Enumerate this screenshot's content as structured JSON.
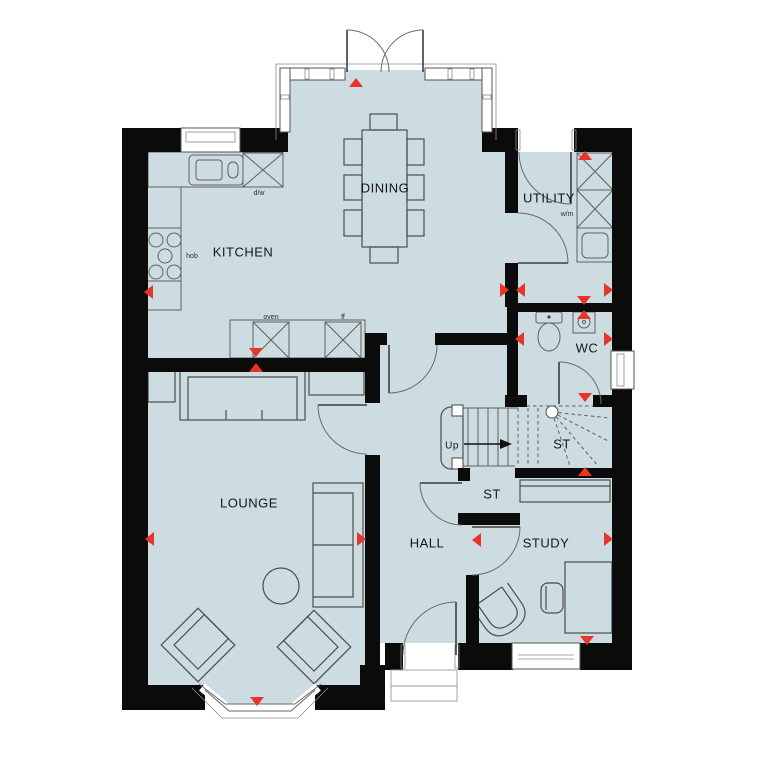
{
  "plan": {
    "type": "ground-floor-plan",
    "colors": {
      "floor": "#ccdce1",
      "wall": "#0b0b0b",
      "marker": "#e8352b",
      "outline": "#4d4d4d"
    },
    "rooms": [
      {
        "id": "dining",
        "label": "DINING",
        "x": 385,
        "y": 189,
        "size": 13
      },
      {
        "id": "kitchen",
        "label": "KITCHEN",
        "x": 243,
        "y": 253,
        "size": 13
      },
      {
        "id": "utility",
        "label": "UTILITY",
        "x": 549,
        "y": 199,
        "size": 13
      },
      {
        "id": "wc",
        "label": "WC",
        "x": 587,
        "y": 349,
        "size": 13
      },
      {
        "id": "st-stairs",
        "label": "ST",
        "x": 562,
        "y": 445,
        "size": 13
      },
      {
        "id": "st-store",
        "label": "ST",
        "x": 492,
        "y": 495,
        "size": 13
      },
      {
        "id": "lounge",
        "label": "LOUNGE",
        "x": 249,
        "y": 504,
        "size": 13
      },
      {
        "id": "hall",
        "label": "HALL",
        "x": 427,
        "y": 544,
        "size": 13
      },
      {
        "id": "study",
        "label": "STUDY",
        "x": 546,
        "y": 544,
        "size": 13
      }
    ],
    "fixture_labels": [
      {
        "id": "dw",
        "label": "d/w",
        "x": 259,
        "y": 193,
        "size": 7
      },
      {
        "id": "hob",
        "label": "hob",
        "x": 192,
        "y": 256,
        "size": 7
      },
      {
        "id": "oven",
        "label": "oven",
        "x": 271,
        "y": 317,
        "size": 7
      },
      {
        "id": "ff",
        "label": "ff",
        "x": 343,
        "y": 317,
        "size": 7
      },
      {
        "id": "wm",
        "label": "w/m",
        "x": 567,
        "y": 214,
        "size": 7
      }
    ],
    "stairs": {
      "direction_label": "Up",
      "x": 452,
      "y": 446,
      "size": 10
    },
    "markers": [
      {
        "dir": "up",
        "x": 356,
        "y": 83
      },
      {
        "dir": "up",
        "x": 585,
        "y": 156
      },
      {
        "dir": "left",
        "x": 149,
        "y": 292
      },
      {
        "dir": "right",
        "x": 504,
        "y": 290
      },
      {
        "dir": "left",
        "x": 521,
        "y": 290
      },
      {
        "dir": "right",
        "x": 608,
        "y": 290
      },
      {
        "dir": "down",
        "x": 584,
        "y": 300
      },
      {
        "dir": "up",
        "x": 584,
        "y": 315
      },
      {
        "dir": "down",
        "x": 256,
        "y": 352
      },
      {
        "dir": "up",
        "x": 256,
        "y": 368
      },
      {
        "dir": "left",
        "x": 520,
        "y": 339
      },
      {
        "dir": "right",
        "x": 608,
        "y": 339
      },
      {
        "dir": "down",
        "x": 585,
        "y": 397
      },
      {
        "dir": "up",
        "x": 585,
        "y": 472
      },
      {
        "dir": "left",
        "x": 150,
        "y": 539
      },
      {
        "dir": "right",
        "x": 361,
        "y": 539
      },
      {
        "dir": "left",
        "x": 477,
        "y": 540
      },
      {
        "dir": "right",
        "x": 608,
        "y": 539
      },
      {
        "dir": "down",
        "x": 587,
        "y": 640
      },
      {
        "dir": "down",
        "x": 257,
        "y": 701
      }
    ]
  }
}
